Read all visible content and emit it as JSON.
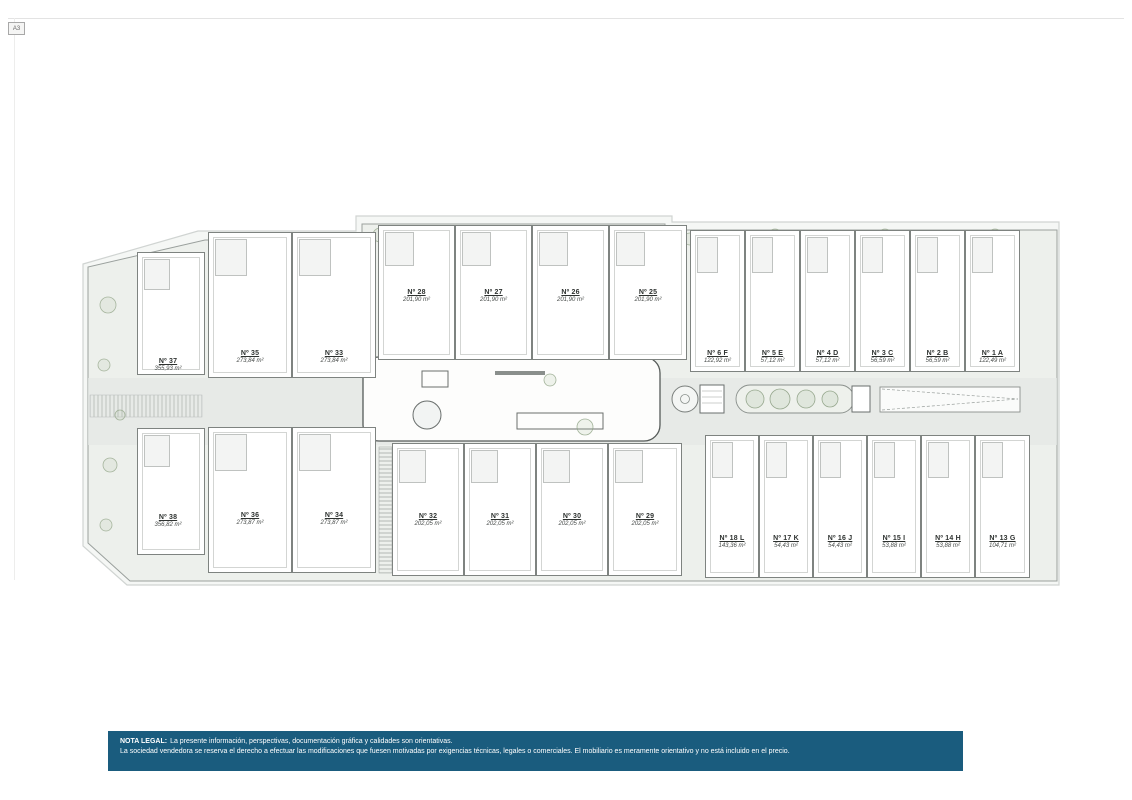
{
  "sheet": {
    "corner_label": "A3"
  },
  "plan": {
    "villas": [
      {
        "number": "Nº 37",
        "area": "355,93 m²"
      },
      {
        "number": "Nº 38",
        "area": "356,82 m²"
      }
    ],
    "semis_top": [
      {
        "number": "Nº 35",
        "area": "273,84 m²"
      },
      {
        "number": "Nº 33",
        "area": "273,84 m²"
      }
    ],
    "semis_bottom": [
      {
        "number": "Nº 36",
        "area": "273,87 m²"
      },
      {
        "number": "Nº 34",
        "area": "273,87 m²"
      }
    ],
    "row_top": [
      {
        "number": "Nº 28",
        "area": "201,90 m²"
      },
      {
        "number": "Nº 27",
        "area": "201,90 m²"
      },
      {
        "number": "Nº 26",
        "area": "201,90 m²"
      },
      {
        "number": "Nº 25",
        "area": "201,90 m²"
      }
    ],
    "row_bottom": [
      {
        "number": "Nº 32",
        "area": "202,05 m²"
      },
      {
        "number": "Nº 31",
        "area": "202,05 m²"
      },
      {
        "number": "Nº 30",
        "area": "202,05 m²"
      },
      {
        "number": "Nº 29",
        "area": "202,05 m²"
      }
    ],
    "right_top": [
      {
        "number": "Nº 6 F",
        "area": "122,92 m²"
      },
      {
        "number": "Nº 5 E",
        "area": "57,12 m²"
      },
      {
        "number": "Nº 4 D",
        "area": "57,12 m²"
      },
      {
        "number": "Nº 3 C",
        "area": "56,59 m²"
      },
      {
        "number": "Nº 2 B",
        "area": "56,59 m²"
      },
      {
        "number": "Nº 1 A",
        "area": "122,49 m²"
      }
    ],
    "right_bottom": [
      {
        "number": "Nº 18 L",
        "area": "143,36 m²"
      },
      {
        "number": "Nº 17 K",
        "area": "54,43 m²"
      },
      {
        "number": "Nº 16 J",
        "area": "54,43 m²"
      },
      {
        "number": "Nº 15 I",
        "area": "53,88 m²"
      },
      {
        "number": "Nº 14 H",
        "area": "53,88 m²"
      },
      {
        "number": "Nº 13 G",
        "area": "104,71 m²"
      }
    ]
  },
  "legal": {
    "label": "NOTA LEGAL:",
    "line1": "La presente información, perspectivas, documentación gráfica y calidades son orientativas.",
    "line2": "La sociedad vendedora se reserva el derecho a efectuar las modificaciones que fuesen motivadas por exigencias técnicas, legales o comerciales. El mobiliario es meramente orientativo y no está incluido en el precio.",
    "colors": {
      "bar": "#1a5c7e",
      "text": "#ffffff"
    }
  }
}
